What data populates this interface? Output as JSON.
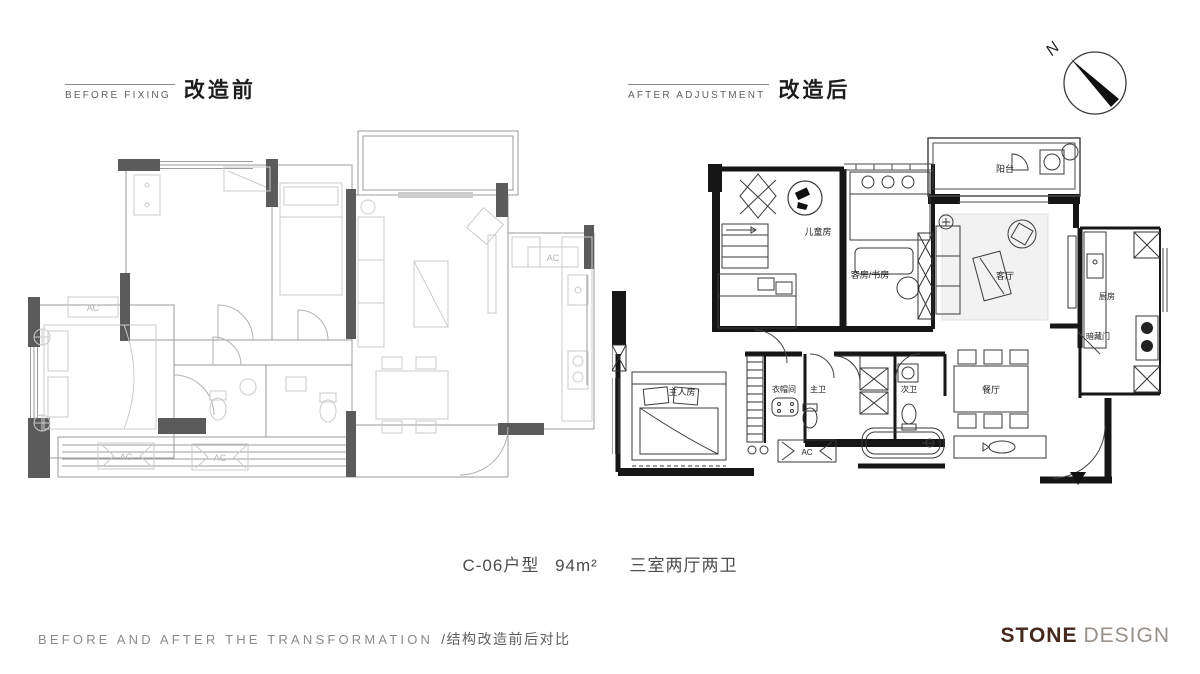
{
  "header": {
    "before": {
      "en": "BEFORE FIXING",
      "zh": "改造前"
    },
    "after": {
      "en": "AFTER ADJUSTMENT",
      "zh": "改造后"
    },
    "compass": {
      "letter": "N"
    }
  },
  "caption": {
    "unit": "C-06户型",
    "area": "94m²",
    "layout": "三室两厅两卫"
  },
  "before_plan": {
    "ac_label": "AC"
  },
  "after_plan": {
    "rooms": {
      "children_room": "儿童房",
      "guest_study": "客房/书房",
      "balcony": "阳台",
      "living_room": "客厅",
      "kitchen": "厨房",
      "hidden_door": "暗藏门",
      "master_bedroom": "主人房",
      "cloakroom": "衣帽间",
      "master_bath": "主卫",
      "second_bath": "次卫",
      "dining_room": "餐厅",
      "ac": "AC"
    }
  },
  "footer": {
    "title_en": "BEFORE AND AFTER THE TRANSFORMATION",
    "title_zh": "/结构改造前后对比",
    "logo_primary": "STONE",
    "logo_secondary": "DESIGN"
  }
}
